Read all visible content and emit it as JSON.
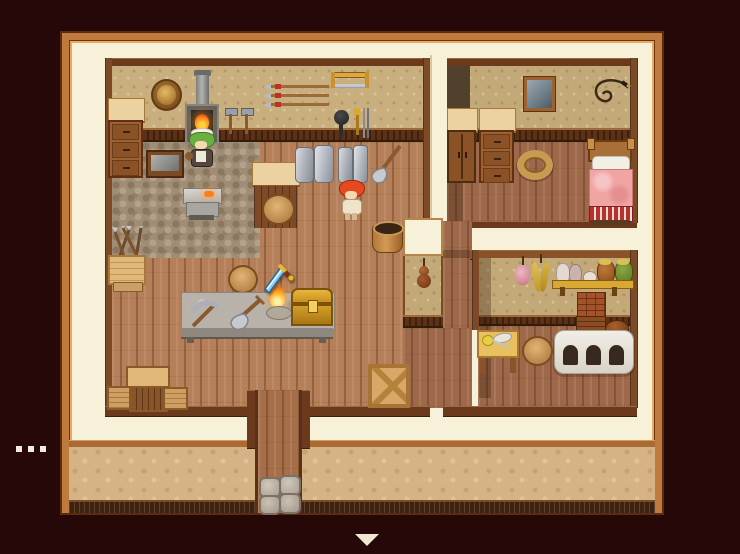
{
  "app": {
    "kind": "top-down RPG game screen",
    "scene_label": "Blacksmith's house interior"
  },
  "palette": {
    "background": "#270808",
    "outer_wall_cream": "#f8f1da",
    "frame_wood": "#c07a3e",
    "wallpaper": "#c9ae7e",
    "floor_planks": "#b57f59",
    "wainscot": "#5d3116",
    "exterior_stucco": "#d5b384",
    "bed_blanket": "#f0a4a4",
    "chest_gold": "#c79020",
    "fire": "#ff8c1e",
    "cursor_blade": "#8ecdf2"
  },
  "scene": {
    "rooms": [
      {
        "id": "smithy",
        "label": "Blacksmith workshop",
        "objects": [
          "round wall shield",
          "forge with chimney and fire",
          "two wall hammers",
          "spear rack",
          "bow saw",
          "hanging pan and tongs",
          "drawer dresser",
          "grindstone table",
          "anvil workbench with hot metal",
          "metal ingot sheets",
          "leaning shovel",
          "wooden bucket",
          "shop counter",
          "round stools",
          "box of spears",
          "wooden crates and bench",
          "stone work table",
          "pickaxe on table",
          "shovel on table",
          "candle flame on table",
          "treasure chest on table",
          "crate with X braces"
        ]
      },
      {
        "id": "bedroom",
        "label": "Bedroom",
        "objects": [
          "shadowed corner",
          "two-door cupboard",
          "drawer dresser",
          "framed picture",
          "coiled whip on wall",
          "rope coil on floor",
          "bed with pink blanket and striped footer"
        ]
      },
      {
        "id": "kitchen",
        "label": "Kitchen",
        "objects": [
          "hanging garlic bunch",
          "hanging corn bunch",
          "shelf with jugs and pots",
          "brick chimney",
          "white masonry oven",
          "round stool",
          "preparation table with food and knife",
          "hanging gourd on dividing wall"
        ]
      },
      {
        "id": "exterior",
        "label": "House front",
        "objects": [
          "front door walkway",
          "stepping stones",
          "stucco wall with baseboard"
        ]
      }
    ],
    "characters": [
      {
        "id": "maid-npc",
        "desc": "green-haired maid working at the anvil"
      },
      {
        "id": "red-haired-npc",
        "desc": "red-haired villager standing by the wall"
      }
    ],
    "cursor": {
      "icon": "sword-cursor",
      "desc": "blue sword pointer over the work table"
    }
  },
  "ui": {
    "message_ellipsis": {
      "dot_count": 3,
      "desc": "three white dots at lower left"
    },
    "continue_indicator": {
      "glyph": "down-triangle",
      "desc": "cream triangle below the house"
    }
  }
}
